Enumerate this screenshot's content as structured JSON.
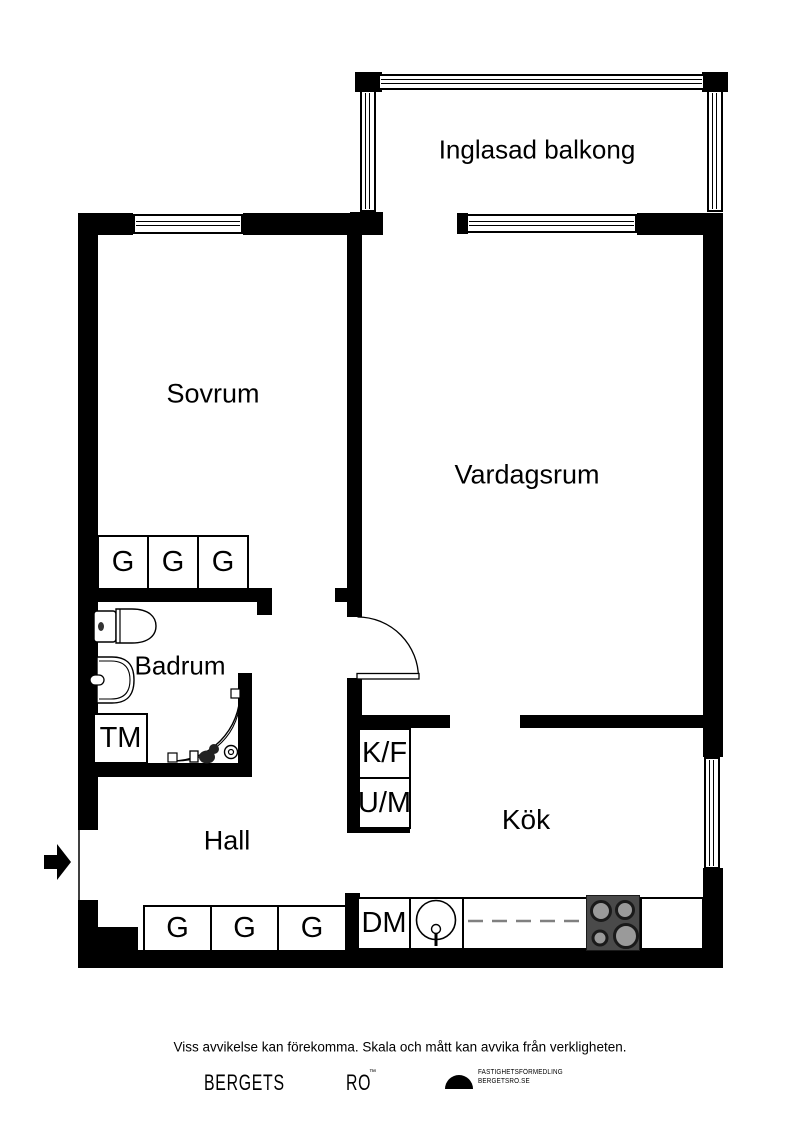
{
  "plan": {
    "rooms": {
      "balcony": "Inglasad balkong",
      "bedroom": "Sovrum",
      "living": "Vardagsrum",
      "bathroom": "Badrum",
      "hall": "Hall",
      "kitchen": "Kök"
    },
    "appliances": {
      "washing_machine": "TM",
      "fridge_freezer": "K/F",
      "oven_microwave": "U/M",
      "dishwasher": "DM"
    },
    "wardrobes": {
      "bedroom": [
        "G",
        "G",
        "G"
      ],
      "hall": [
        "G",
        "G",
        "G"
      ]
    }
  },
  "footer": {
    "disclaimer": "Viss avvikelse kan förekomma. Skala och mått kan avvika från verkligheten.",
    "brand": {
      "primary": "BERGETS",
      "secondary": "RO",
      "mark": "™",
      "tagline_line1": "FASTIGHETSFÖRMEDLING",
      "tagline_line2": "BERGETSRO.SE"
    }
  },
  "colors": {
    "wall": "#000000",
    "stove_body": "#4a4a4a",
    "burner_fill": "#9a9a9a",
    "counter_dash": "#808080"
  }
}
